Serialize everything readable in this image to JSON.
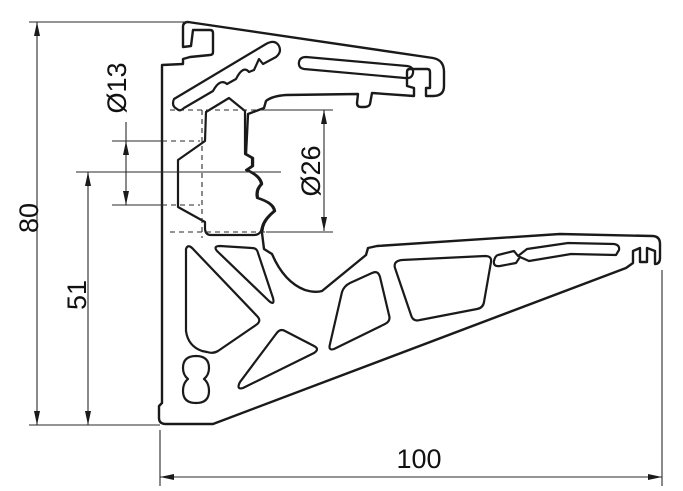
{
  "drawing": {
    "background": "#ffffff",
    "line_color": "#1a1a1a",
    "labels": {
      "overall_height": "80",
      "bracket_height": "51",
      "small_hole_dia": "Ø13",
      "large_hole_dia": "Ø26",
      "overall_width": "100"
    }
  }
}
